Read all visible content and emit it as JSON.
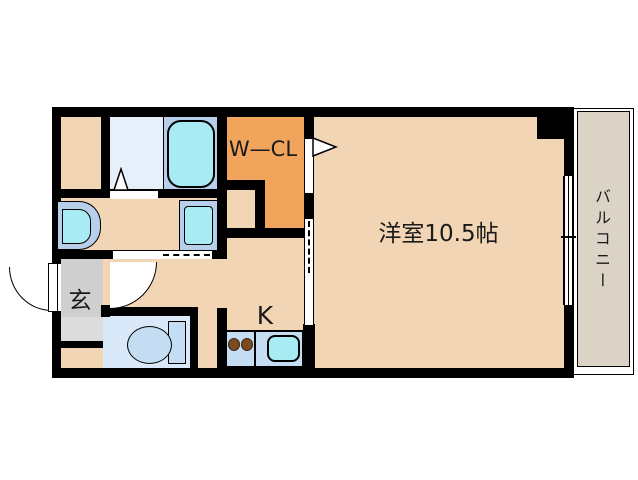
{
  "plan": {
    "type": "apartment-floor-plan",
    "rooms": {
      "main_room": {
        "label": "洋室10.5帖"
      },
      "walk_in_closet": {
        "label": "W—CL"
      },
      "balcony": {
        "label": "バルコニー"
      },
      "entrance": {
        "label": "玄"
      },
      "kitchen": {
        "label": "K"
      }
    },
    "fixtures": [
      "bathtub",
      "vanity-sink",
      "washer-pan",
      "toilet",
      "kitchen-counter",
      "stove-burners",
      "kitchen-sink",
      "entrance-door",
      "hall-door",
      "bath-door",
      "wcl-door",
      "sliding-door",
      "balcony-window"
    ]
  },
  "colors": {
    "wall": "#000000",
    "bg": "#ffffff",
    "text": "#1a1a1a",
    "floor-peach": "#f2d5b5",
    "floor-orange": "#f0a45c",
    "floor-bath": "#e6f0fa",
    "floor-toilet": "#d9e9f9",
    "floor-entrance-upper": "#cfcfcf",
    "floor-entrance-lower": "#dcdcdc",
    "floor-balcony": "#dbd3c6",
    "fixture-band": "#b8cfec",
    "fixture-cyan": "#a9ebf2",
    "fixture-light": "#c5ddf2",
    "burner": "#7b4a21"
  }
}
